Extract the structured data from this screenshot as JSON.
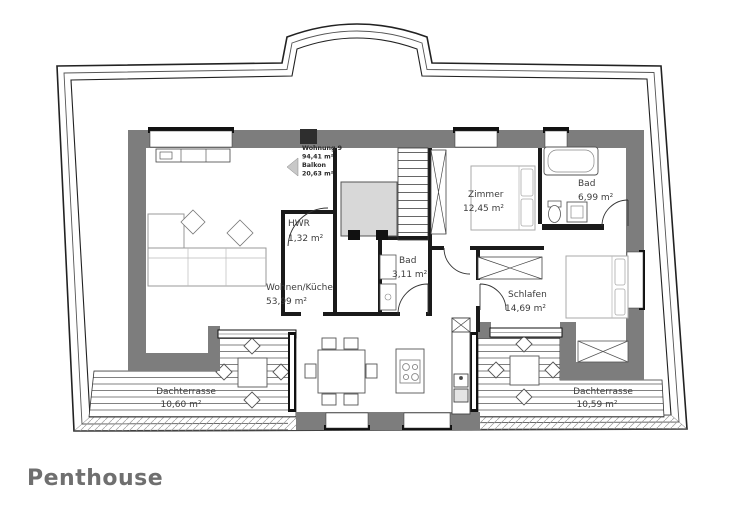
{
  "title": "Penthouse",
  "unit_tag": {
    "unit": "Wohnung 9",
    "unit_area": "94,41 m²",
    "balcony": "Balkon",
    "balcony_area": "20,63 m²"
  },
  "rooms": {
    "wohnen_name": "Wohnen/Küche",
    "wohnen_area": "53,99 m²",
    "hwr_name": "HWR",
    "hwr_area": "1,32 m²",
    "bad_small_name": "Bad",
    "bad_small_area": "3,11 m²",
    "zimmer_name": "Zimmer",
    "zimmer_area": "12,45 m²",
    "bad_name": "Bad",
    "bad_area": "6,99 m²",
    "schlafen_name": "Schlafen",
    "schlafen_area": "14,69 m²",
    "terrace_left_name": "Dachterrasse",
    "terrace_left_area": "10,60 m²",
    "terrace_right_name": "Dachterrasse",
    "terrace_right_area": "10,59 m²"
  },
  "colors": {
    "wall_gray": "#7d7d7d",
    "line_black": "#1a1a1a",
    "stair_gray": "#d8d8d8",
    "label_gray": "#3d3d3d",
    "title_gray": "#6f6f6f"
  }
}
